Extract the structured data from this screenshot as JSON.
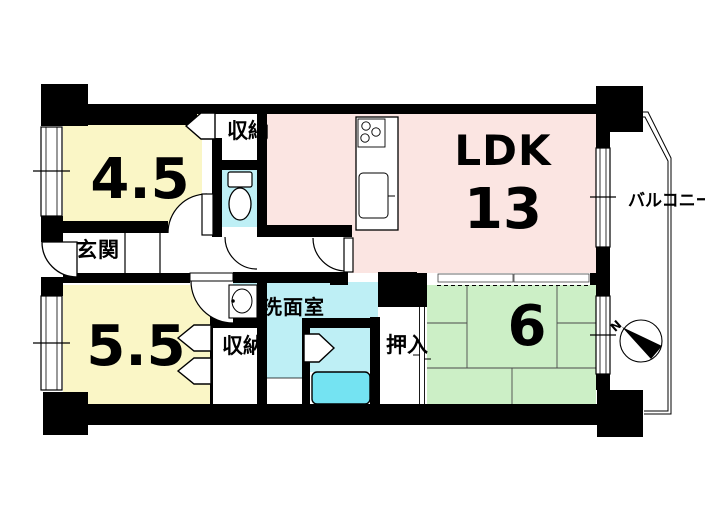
{
  "floorplan": {
    "rooms": {
      "room45": {
        "label": "4.5"
      },
      "room55": {
        "label": "5.5"
      },
      "ldk": {
        "label": "LDK",
        "size": "13"
      },
      "tatami6": {
        "label": "6"
      },
      "entrance": {
        "label": "玄関"
      },
      "washroom": {
        "label": "洗面室"
      },
      "closet_top": {
        "label": "収納"
      },
      "closet_bottom": {
        "label": "収納"
      },
      "oshiire": {
        "label": "押入"
      },
      "balcony": {
        "label": "バルコニー"
      }
    },
    "compass": {
      "north_label": "N"
    },
    "colors": {
      "room_yellow": "#FAF6C6",
      "room_pink": "#FBE5E2",
      "room_green": "#CCEFC6",
      "room_cyan": "#BEEFF5",
      "tub_cyan": "#74E3F2",
      "wall_black": "#000000"
    }
  }
}
